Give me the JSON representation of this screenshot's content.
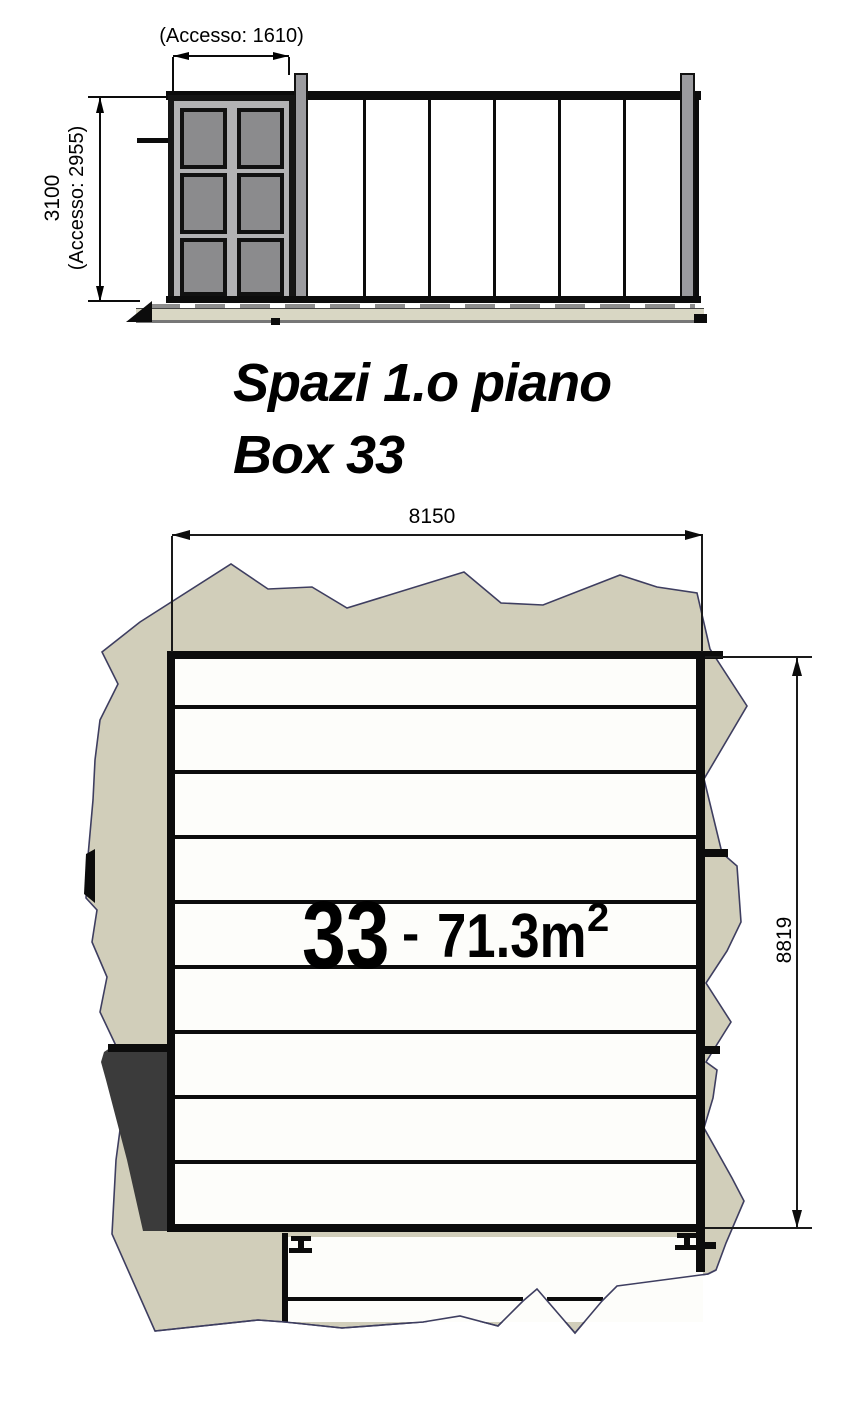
{
  "elevation": {
    "access_width_label": "(Accesso: 1610)",
    "height_label": "3100",
    "access_height_label": "(Accesso: 2955)"
  },
  "title": {
    "line1": "Spazi 1.o piano",
    "line2": "Box 33"
  },
  "plan": {
    "width_label": "8150",
    "height_label": "8819",
    "box_number": "33",
    "separator": "-",
    "area_value": "71.3m",
    "area_exponent": "2"
  },
  "colors": {
    "terrain_fill": "#d1ceba",
    "terrain_stroke": "#3e3e60",
    "dark_block": "#3b3b3b",
    "base_beige": "#d9d7c4",
    "door_panel": "#8b8b8d",
    "door_leaf": "#b2b2b4",
    "post": "#9b9b9f"
  }
}
